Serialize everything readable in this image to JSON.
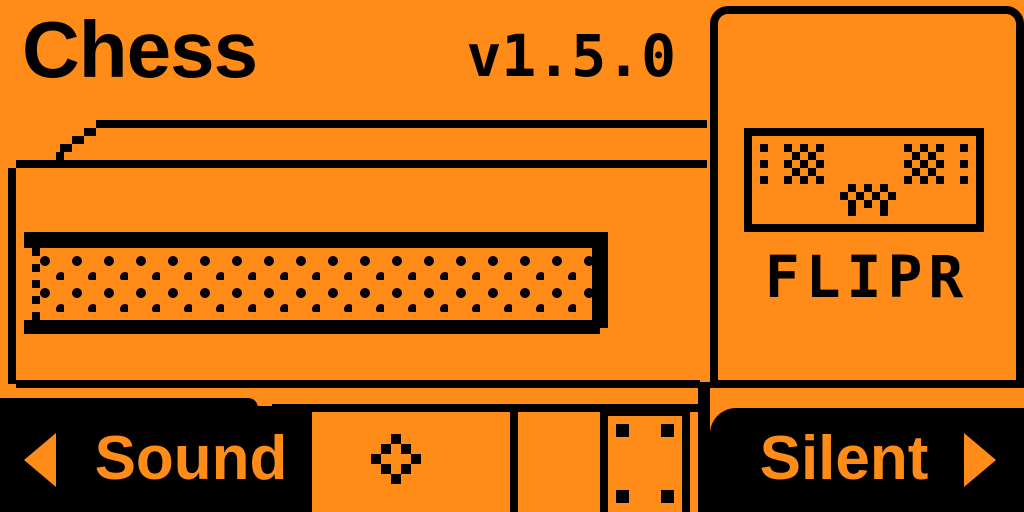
{
  "app": {
    "title": "Chess",
    "version": "v1.5.0"
  },
  "opponent_panel": {
    "name": "FLIPR",
    "face_icon": "flipr-robot-face"
  },
  "controls": {
    "left_button": {
      "label": "Sound",
      "arrow_icon": "left-arrow-icon"
    },
    "right_button": {
      "label": "Silent",
      "arrow_icon": "right-arrow-icon"
    },
    "ok_button": {
      "glyph_icon": "ok-diamond-icon"
    }
  },
  "graphics": {
    "main_illustration": "chess-table-in-perspective-with-dithered-edge",
    "leg_icon": "table-leg-with-corner-screws"
  },
  "colors": {
    "background": "#ff8c18",
    "ink": "#000000"
  },
  "pixel_icons": {
    "eye": {
      "cell": 8,
      "rows": [
        "10101",
        "01010",
        "10101",
        "01010",
        "10101"
      ]
    },
    "dot_column": {
      "cell": 8,
      "rows": [
        "1",
        "0",
        "1",
        "0",
        "1"
      ]
    },
    "mouth": {
      "cell": 8,
      "rows": [
        "0101010",
        "1010101",
        "0101010",
        "0100010"
      ]
    },
    "ok_diamond": {
      "cell": 10,
      "rows": [
        "00100",
        "01010",
        "10001",
        "01010",
        "00100"
      ]
    }
  }
}
